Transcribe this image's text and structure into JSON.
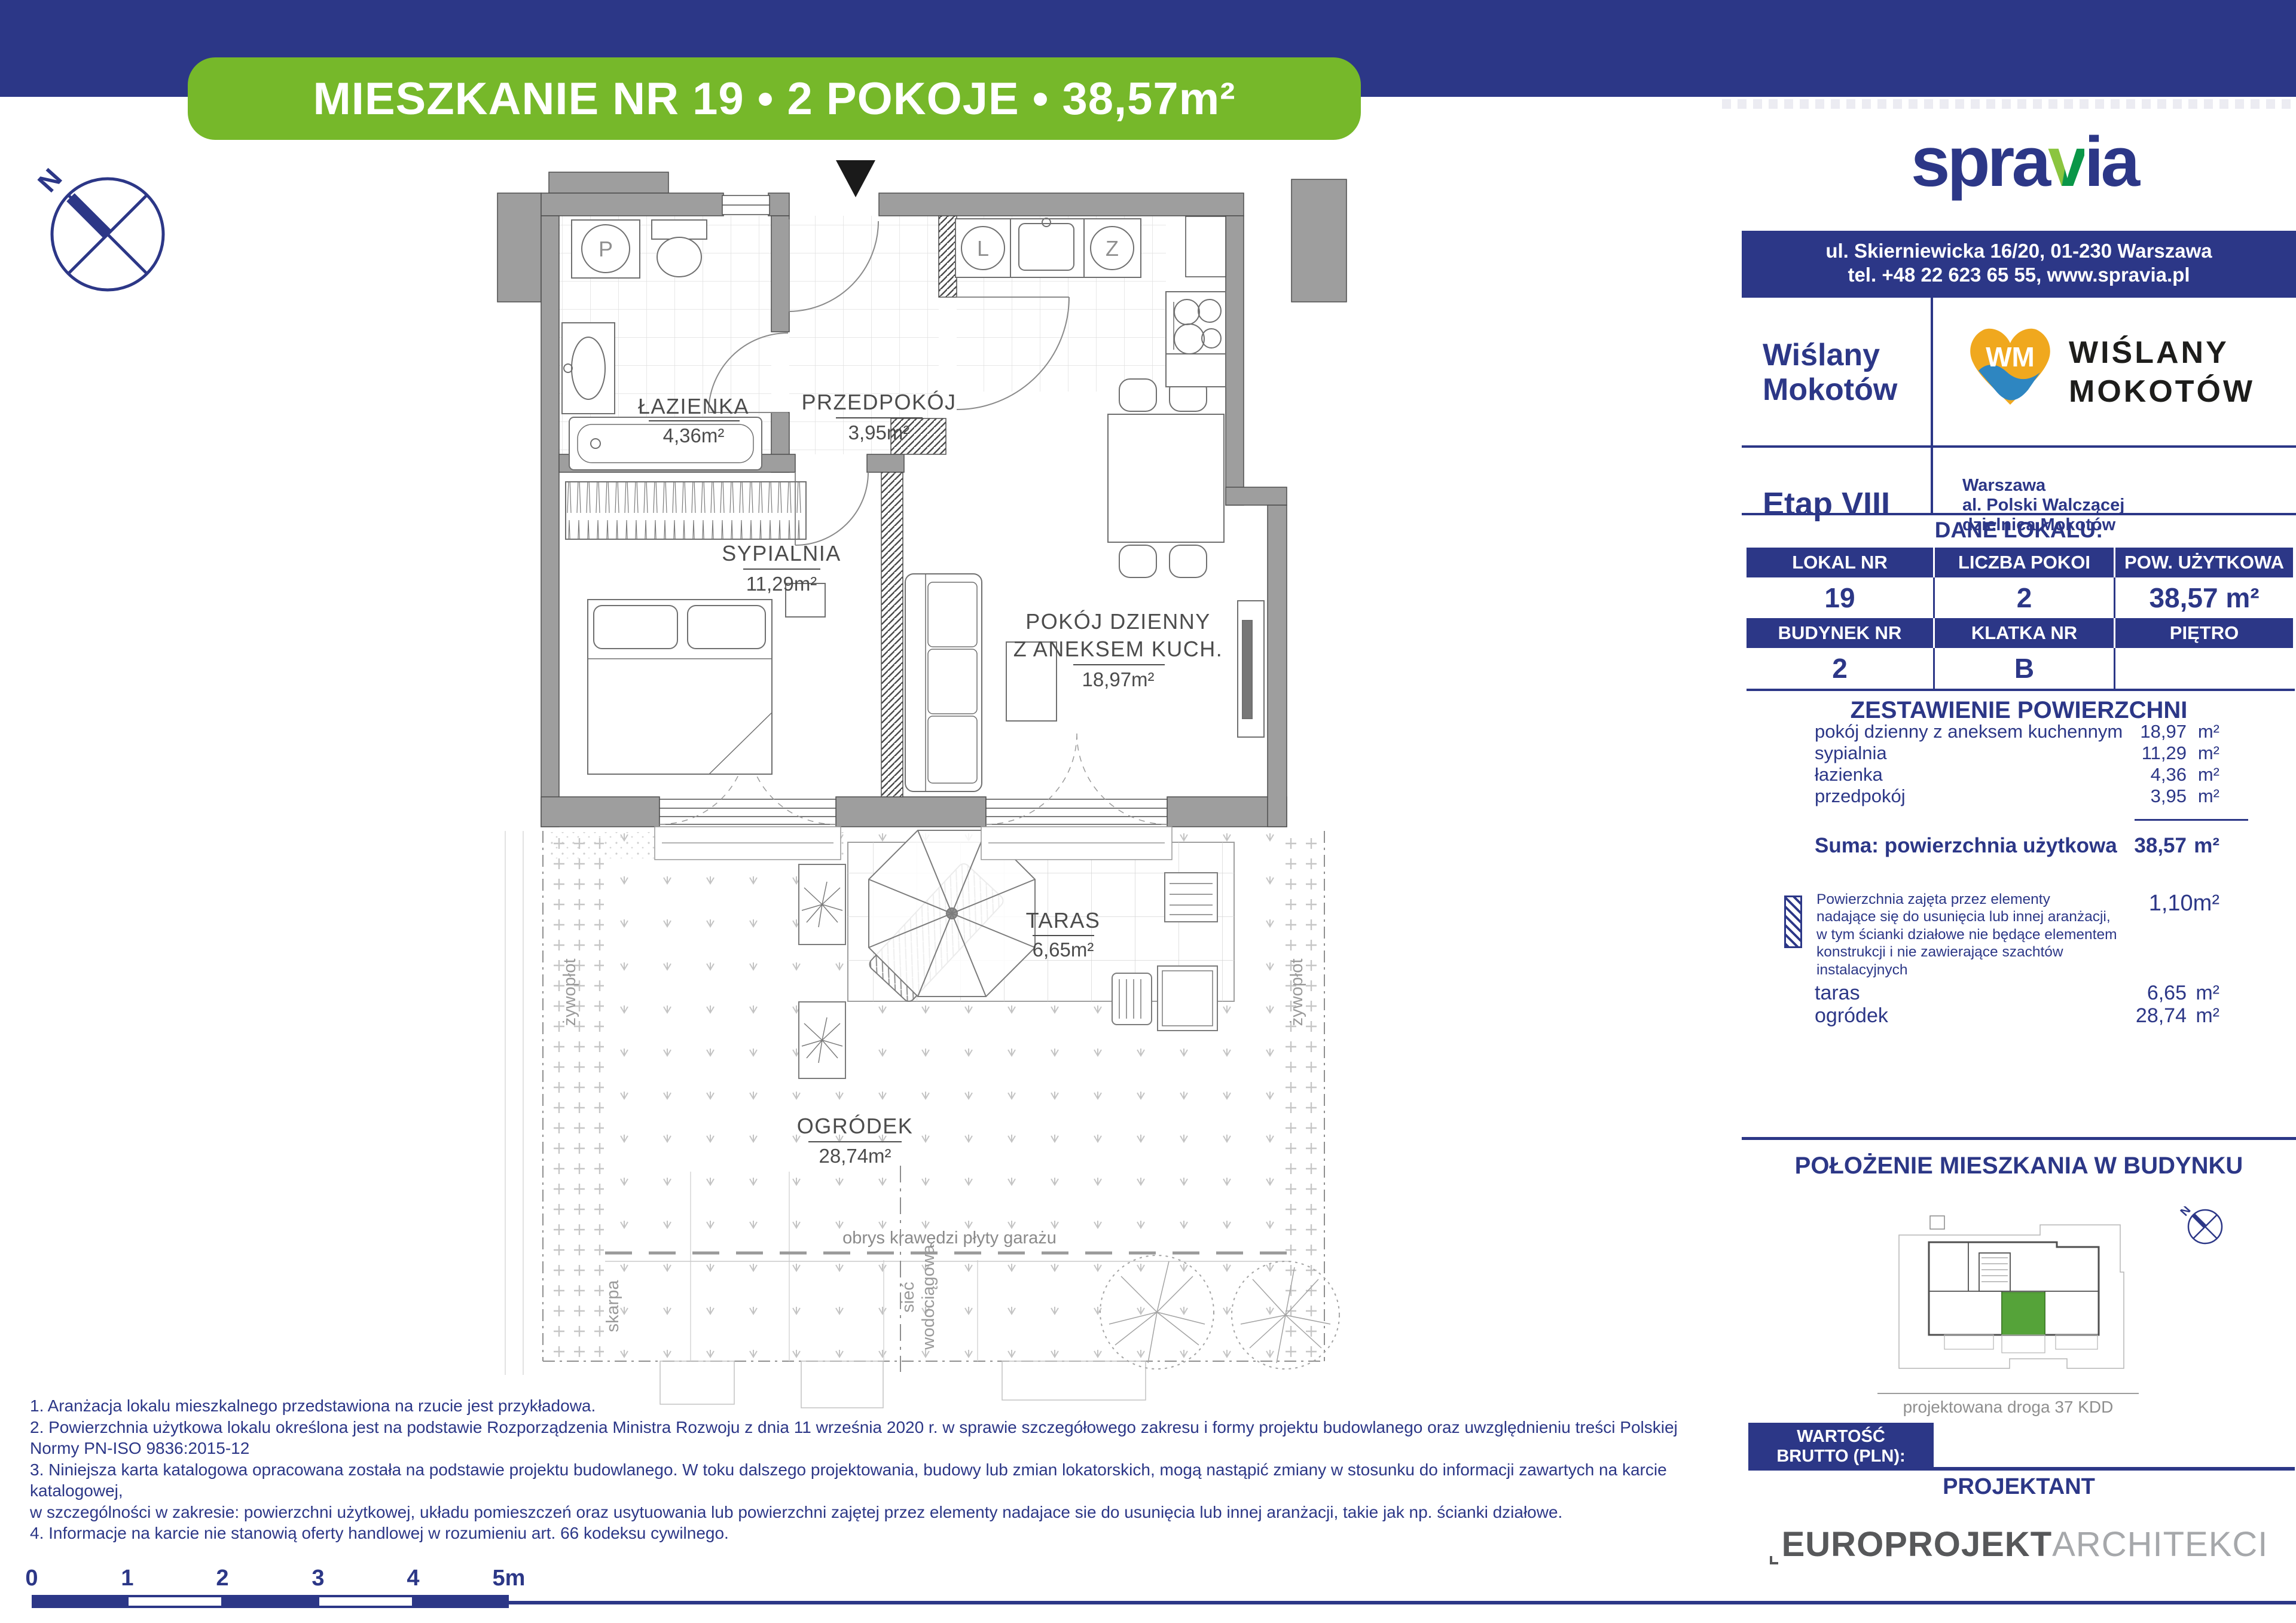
{
  "colors": {
    "navy": "#2c3787",
    "green": "#76b82a",
    "logo_green_light": "#8bc53f",
    "logo_green_dark": "#0a9648",
    "wm_yellow": "#f0a81e",
    "wm_blue": "#2e86c1",
    "wall_gray": "#9e9e9e",
    "unit_green": "#55a339"
  },
  "header": {
    "title": "MIESZKANIE NR 19 • 2 POKOJE • 38,57m²"
  },
  "compass": {
    "north": "N"
  },
  "floor_plan": {
    "rooms": [
      {
        "name": "ŁAZIENKA",
        "area": "4,36m²"
      },
      {
        "name": "PRZEDPOKÓJ",
        "area": "3,95m²"
      },
      {
        "name": "SYPIALNIA",
        "area": "11,29m²"
      },
      {
        "name": "POKÓJ DZIENNY",
        "name2": "Z ANEKSEM KUCH.",
        "area": "18,97m²"
      },
      {
        "name": "TARAS",
        "area": "6,65m²"
      },
      {
        "name": "OGRÓDEK",
        "area": "28,74m²"
      }
    ],
    "fixtures": {
      "washer": "P",
      "fridge": "L",
      "freezer": "Z"
    },
    "annotations": {
      "hedge_left": "żywopłot",
      "hedge_right": "żywopłot",
      "slope": "skarpa",
      "water1": "sieć",
      "water2": "wodociągowa",
      "garage_edge": "obrys krawędzi płyty garażu"
    }
  },
  "sidebar": {
    "logo": {
      "part1": "spra",
      "accent": "v",
      "part2": "ia"
    },
    "address": {
      "line1": "ul. Skierniewicka 16/20, 01-230 Warszawa",
      "line2": "tel. +48 22 623 65 55, www.spravia.pl"
    },
    "project": {
      "name_line1": "Wiślany",
      "name_line2": "Mokotów",
      "monogram": "WM",
      "logo_line1": "WIŚLANY",
      "logo_line2": "MOKOTÓW",
      "stage": "Etap VIII",
      "city": "Warszawa",
      "street": "al. Polski Walczącej",
      "district": "dzielnica Mokotów"
    },
    "unit_section_title": "DANE LOKALU:",
    "table": {
      "row1_headers": [
        "LOKAL NR",
        "LICZBA POKOI",
        "POW. UŻYTKOWA"
      ],
      "row1_values": [
        "19",
        "2",
        "38,57 m²"
      ],
      "row2_headers": [
        "BUDYNEK NR",
        "KLATKA NR",
        "PIĘTRO"
      ],
      "row2_values": [
        "2",
        "B",
        "PARTER"
      ]
    },
    "areas": {
      "title": "ZESTAWIENIE POWIERZCHNI",
      "unit": "m²",
      "rows": [
        {
          "label": "pokój dzienny z aneksem kuchennym",
          "value": "18,97"
        },
        {
          "label": "sypialnia",
          "value": "11,29"
        },
        {
          "label": "łazienka",
          "value": "4,36"
        },
        {
          "label": "przedpokój",
          "value": "3,95"
        }
      ],
      "sum_label": "Suma: powierzchnia użytkowa",
      "sum_value": "38,57"
    },
    "legend": {
      "lines": [
        "Powierzchnia zajęta przez elementy",
        "nadające się do usunięcia lub innej aranżacji,",
        "w tym ścianki działowe nie będące elementem",
        "konstrukcji i nie zawierające szachtów instalacyjnych"
      ],
      "value": "1,10m²"
    },
    "outdoor": {
      "unit": "m²",
      "rows": [
        {
          "label": "taras",
          "value": "6,65"
        },
        {
          "label": "ogródek",
          "value": "28,74"
        }
      ]
    },
    "location": {
      "title": "POŁOŻENIE MIESZKANIA W BUDYNKU",
      "caption": "projektowana droga 37 KDD"
    },
    "price": {
      "label_line1": "WARTOŚĆ",
      "label_line2": "BRUTTO (PLN):",
      "value": ""
    },
    "designer": {
      "label": "PROJEKTANT",
      "brand_bold": "EUROPROJEKT",
      "brand_light": "ARCHITEKCI"
    }
  },
  "footnotes": [
    "1. Aranżacja lokalu mieszkalnego przedstawiona na rzucie jest przykładowa.",
    "2. Powierzchnia użytkowa lokalu określona jest na podstawie Rozporządzenia Ministra Rozwoju z dnia 11 września 2020 r. w sprawie szczegółowego zakresu i formy projektu budowlanego oraz uwzględnieniu treści Polskiej Normy PN-ISO 9836:2015-12",
    "3. Niniejsza karta katalogowa opracowana została na podstawie projektu budowlanego. W toku dalszego projektowania, budowy lub zmian lokatorskich, mogą nastąpić zmiany w stosunku do informacji zawartych na karcie katalogowej,",
    "w szczególności w zakresie: powierzchni użytkowej, układu pomieszczeń oraz usytuowania lub powierzchni zajętej przez elementy nadajace sie do usunięcia lub innej aranżacji, takie jak np. ścianki działowe.",
    "4. Informacje na karcie nie stanowią oferty handlowej w rozumieniu art. 66 kodeksu cywilnego."
  ],
  "scale_bar": {
    "labels": [
      "0",
      "1",
      "2",
      "3",
      "4",
      "5m"
    ]
  }
}
